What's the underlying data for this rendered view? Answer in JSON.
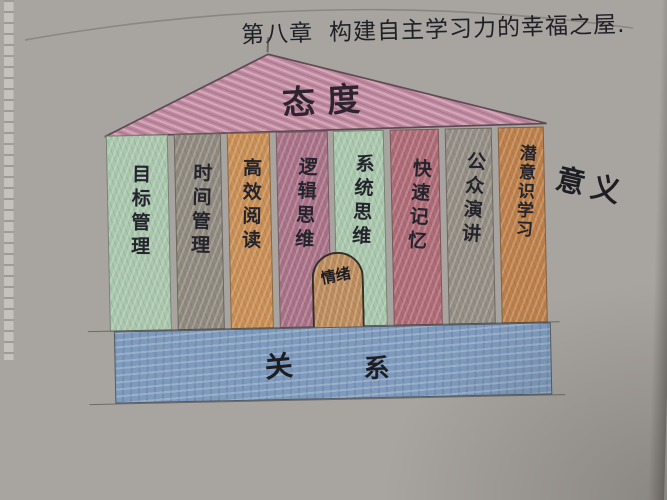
{
  "title": {
    "chapter": "第八章",
    "text": "构建自主学习力的幸福之屋."
  },
  "temple": {
    "roof_label": "态度",
    "side_label": "意义",
    "door_label": "情绪",
    "base_label": {
      "char1": "关",
      "char2": "系"
    },
    "columns": [
      {
        "label": "目标管理",
        "color": "#a9c7ad"
      },
      {
        "label": "时间管理",
        "color": "#8f897f"
      },
      {
        "label": "高效阅读",
        "color": "#c88e54"
      },
      {
        "label": "逻辑思维",
        "color": "#a97187"
      },
      {
        "label": "系统思维",
        "color": "#a9c7ad"
      },
      {
        "label": "快速记忆",
        "color": "#ae6a76"
      },
      {
        "label": "公众演讲",
        "color": "#938d84"
      },
      {
        "label": "潜意识学习",
        "color": "#bd7f49"
      }
    ],
    "colors": {
      "roof": "#c08ba0",
      "roof_stroke": "#5f4a55",
      "base": "#7e9abd",
      "door": "#bd8c5c",
      "paper": "#d2cfca"
    }
  }
}
